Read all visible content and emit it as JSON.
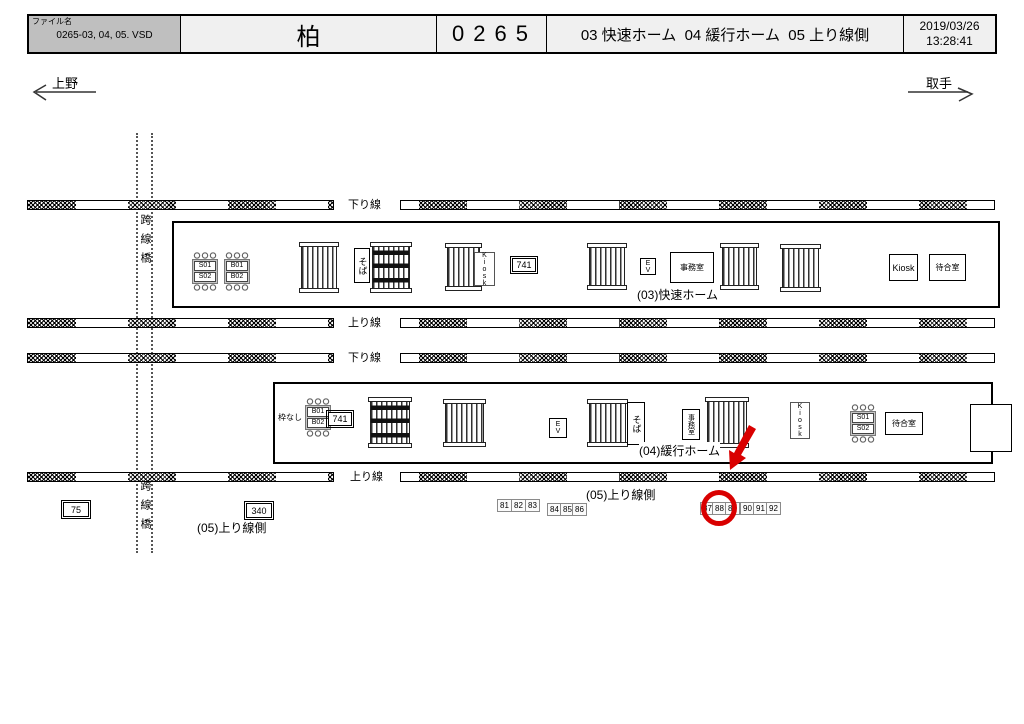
{
  "header": {
    "file_label": "ファイル名",
    "file_name": "0265-03, 04, 05. VSD",
    "station": "柏",
    "number": "0265",
    "platform_list": "03 快速ホーム  04 緩行ホーム  05 上り線側",
    "date": "2019/03/26",
    "time": "13:28:41"
  },
  "directions": {
    "left": "上野",
    "right": "取手"
  },
  "tracks": {
    "t1": "下り線",
    "t2": "上り線",
    "t3": "下り線",
    "t4": "上り線"
  },
  "bridge": {
    "label": "跨線橋"
  },
  "platform03": {
    "label": "(03)快速ホーム",
    "s01": "S01",
    "s02": "S02",
    "b01": "B01",
    "b02": "B02",
    "soba": "そば",
    "kiosk_small": "Kiosk",
    "sign741": "741",
    "ev": "EV",
    "office": "事務室",
    "kiosk": "Kiosk",
    "waiting_room": "待合室"
  },
  "platform04": {
    "label": "(04)緩行ホーム",
    "frame_note": "枠なし",
    "b01": "B01",
    "b02": "B02",
    "sign741": "741",
    "ev": "EV",
    "soba": "そば",
    "office": "事務室",
    "kiosk_small": "Kiosk",
    "s01": "S01",
    "s02": "S02",
    "waiting_room": "待合室"
  },
  "area05": {
    "label_left": "(05)上り線側",
    "label_right": "(05)上り線側",
    "sign75": "75",
    "sign340": "340",
    "signs_left": [
      "81",
      "82",
      "83"
    ],
    "signs_mid": [
      "84",
      "85",
      "86"
    ],
    "signs_right": [
      "87",
      "88",
      "89",
      "90",
      "91",
      "92"
    ],
    "highlighted_sign": "88"
  },
  "colors": {
    "accent_red": "#d90000",
    "header_gray": "#bfbfbf"
  }
}
